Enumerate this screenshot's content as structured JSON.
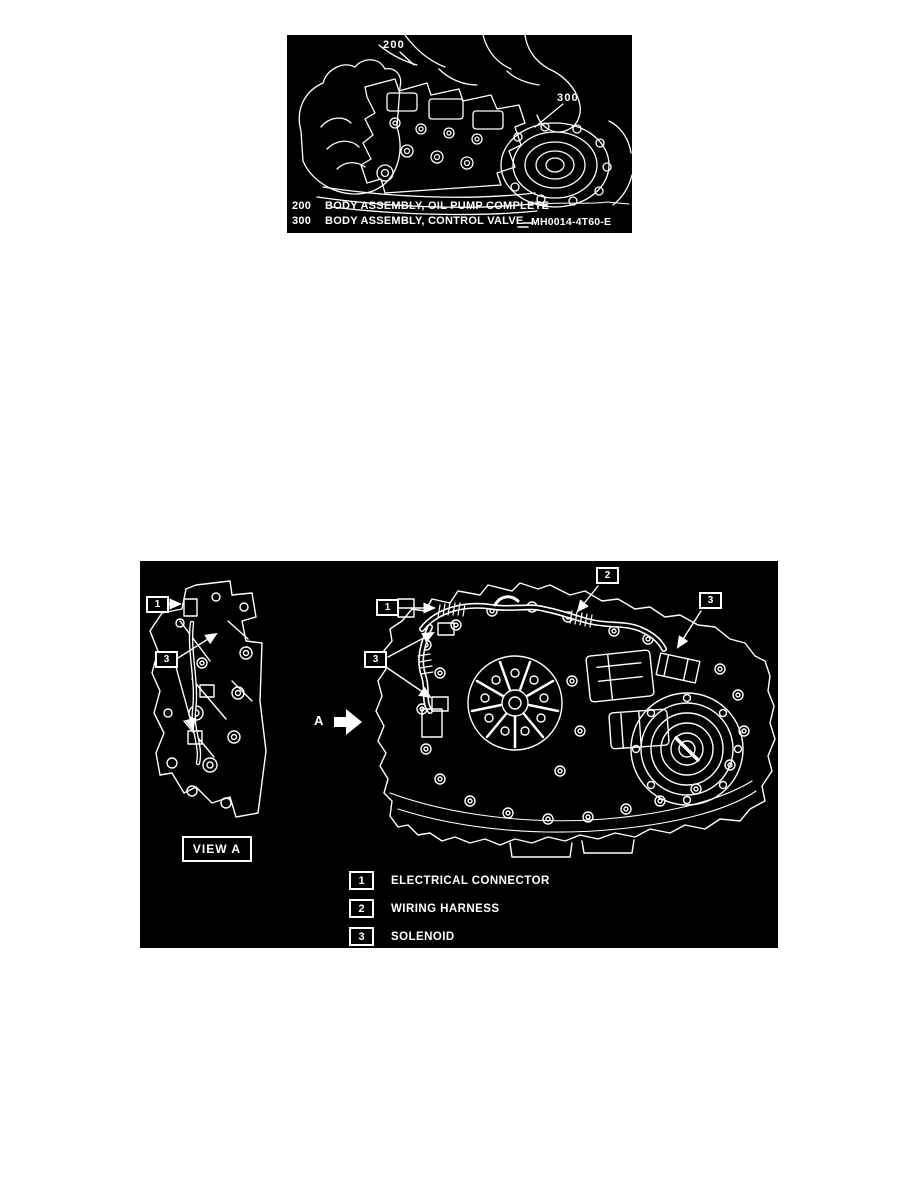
{
  "colors": {
    "page_bg": "#ffffff",
    "figure_bg": "#000000",
    "ink": "#ffffff"
  },
  "figure1": {
    "callout_200": "200",
    "callout_300": "300",
    "legend": [
      {
        "ref": "200",
        "label": "BODY ASSEMBLY, OIL PUMP COMPLETE"
      },
      {
        "ref": "300",
        "label": "BODY ASSEMBLY, CONTROL VALVE"
      }
    ],
    "figure_code": "MH0014-4T60-E"
  },
  "figure2": {
    "view_label": "VIEW A",
    "detail_arrow_label": "A",
    "left_view": {
      "callout_1": "1",
      "callout_3": "3"
    },
    "main_view": {
      "callout_1": "1",
      "callout_2": "2",
      "callout_3_left": "3",
      "callout_3_right": "3"
    },
    "legend": [
      {
        "ref": "1",
        "label": "ELECTRICAL CONNECTOR"
      },
      {
        "ref": "2",
        "label": "WIRING HARNESS"
      },
      {
        "ref": "3",
        "label": "SOLENOID"
      }
    ]
  }
}
